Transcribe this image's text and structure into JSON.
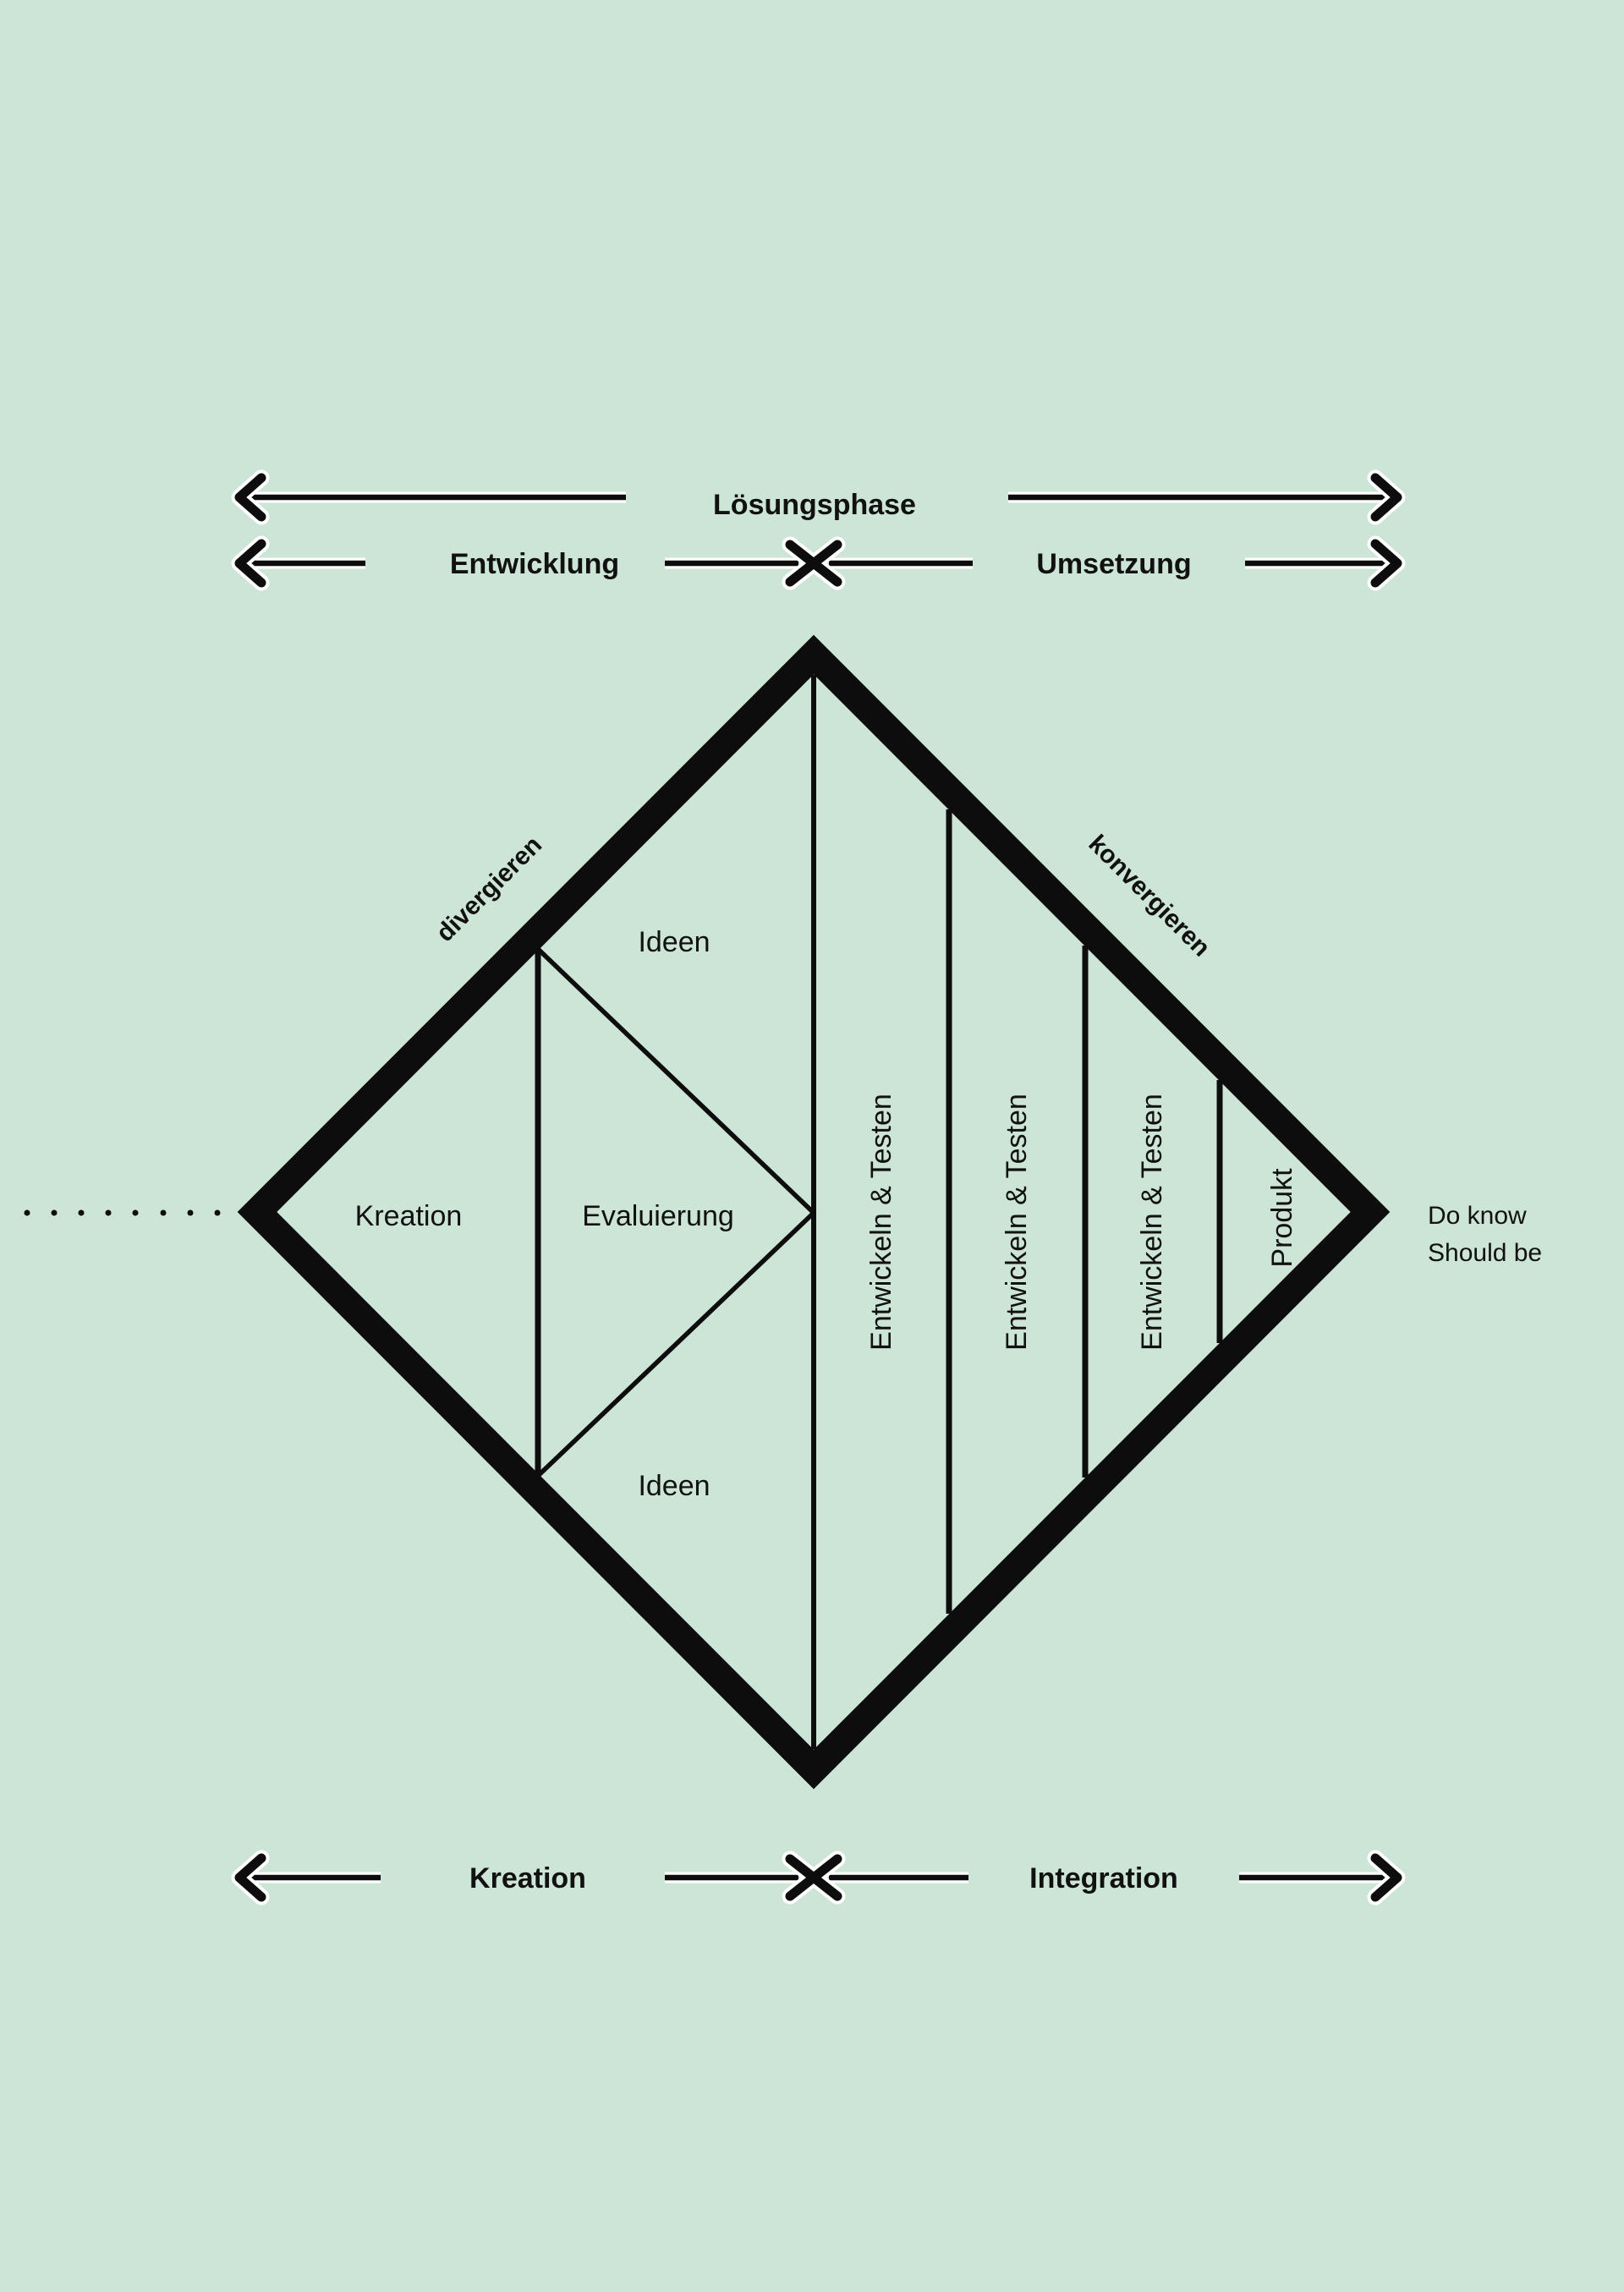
{
  "colors": {
    "background": "#cde5d6",
    "ink": "#0d0d0d",
    "halo": "#ffffff"
  },
  "top_axis": {
    "phase_label": "Lösungsphase",
    "left_label": "Entwicklung",
    "right_label": "Umsetzung"
  },
  "bottom_axis": {
    "left_label": "Kreation",
    "right_label": "Integration"
  },
  "diamond": {
    "edge_labels": {
      "left": "divergieren",
      "right": "konvergieren"
    },
    "left_half": {
      "ideen_top": "Ideen",
      "kreation": "Kreation",
      "evaluierung": "Evaluierung",
      "ideen_bottom": "Ideen"
    },
    "right_half": {
      "bands": [
        "Entwickeln & Testen",
        "Entwickeln & Testen",
        "Entwickeln & Testen"
      ],
      "produkt": "Produkt"
    }
  },
  "annotation": {
    "line1": "Do know",
    "line2": "Should be"
  }
}
